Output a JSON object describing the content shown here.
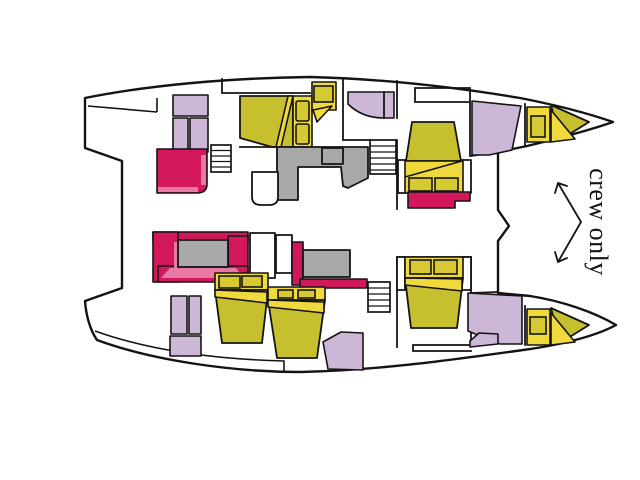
{
  "annotation": {
    "crew_label": "crew only"
  },
  "colors": {
    "ink": "#141414",
    "paper": "#ffffff",
    "bed": "#c6bf2e",
    "bedlight": "#f0d93c",
    "pillow": "#d7c933",
    "lavender": "#ccb7d7",
    "crimson": "#d2175d",
    "pinklight": "#e878a4",
    "gray": "#a8a8a8"
  },
  "legend": {
    "yellow": "double-bed / berth cushions",
    "lavender": "bathroom / wardrobe",
    "crimson": "sofa / seat",
    "gray": "galley counter / table",
    "white-lined": "stairs"
  }
}
